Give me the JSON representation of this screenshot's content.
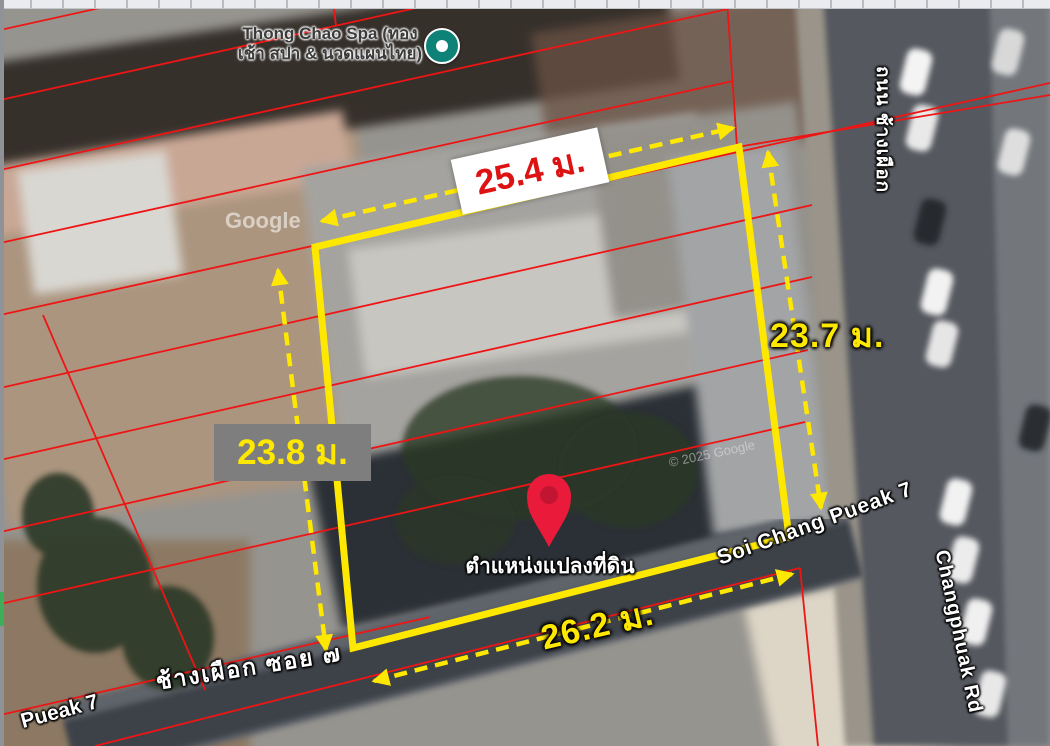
{
  "map": {
    "poi": {
      "name_line1": "Thong Chao Spa (ทอง",
      "name_line2": "เช้า สปา & นวดแผนไทย)"
    },
    "pin_label": "ตำแหน่งแปลงที่ดิน",
    "dimensions": {
      "top": "25.4 ม.",
      "right": "23.7 ม.",
      "left": "23.8 ม.",
      "bottom": "26.2 ม."
    },
    "roads": {
      "soi_en": "Soi Chang Pueak 7",
      "soi_th_bottom": "ช้างเผือก ซอย ๗",
      "soi_en_partial": "Pueak 7",
      "main_road_th": "ถนน ช้างเผือก",
      "main_road_en": "Changphuak Rd"
    },
    "watermarks": {
      "google": "Google",
      "copyright": "© 2025 Google"
    },
    "colors": {
      "plot_outline": "#ffe800",
      "parcel_line": "#ee1515",
      "pin": "#ea1a3a",
      "pin_inner": "#c21531",
      "dimension_yellow": "#ffe800",
      "dimension_red": "#dd1212",
      "poi_icon_teal": "#0e8276"
    }
  }
}
